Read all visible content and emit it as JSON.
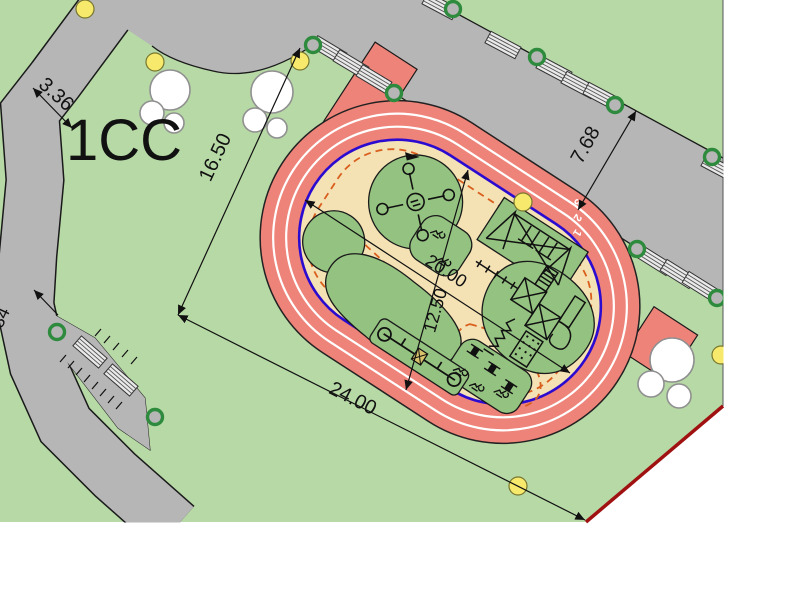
{
  "site_plan": {
    "label": "1CC",
    "dimensions": {
      "path_width": "3.36",
      "track_side": "16.50",
      "plaza_width": "7.68",
      "infield_length": "20.00",
      "infield_width": "12.50",
      "track_length": "24.00",
      "edge_partial": "34"
    },
    "track_lanes": [
      "1",
      "2",
      "3"
    ],
    "colors": {
      "site_green": "#b7d9a6",
      "plaza_gray": "#b6b6b6",
      "track_red": "#ee8379",
      "infield_tan": "#f4e2b4",
      "equipment_green": "#94c280",
      "inner_edge_blue": "#2b0bd0",
      "dashed_path_orange": "#d95f1e",
      "boundary_red": "#a01212",
      "lamp_yellow": "#f7e96b",
      "tree_ring_green": "#2e8b3d"
    },
    "features": [
      "running-track",
      "carousel",
      "swing-set",
      "spring-riders",
      "climbing-structure",
      "seesaw",
      "benches",
      "bike-racks",
      "trees",
      "lamps",
      "footpath",
      "plaza"
    ]
  }
}
